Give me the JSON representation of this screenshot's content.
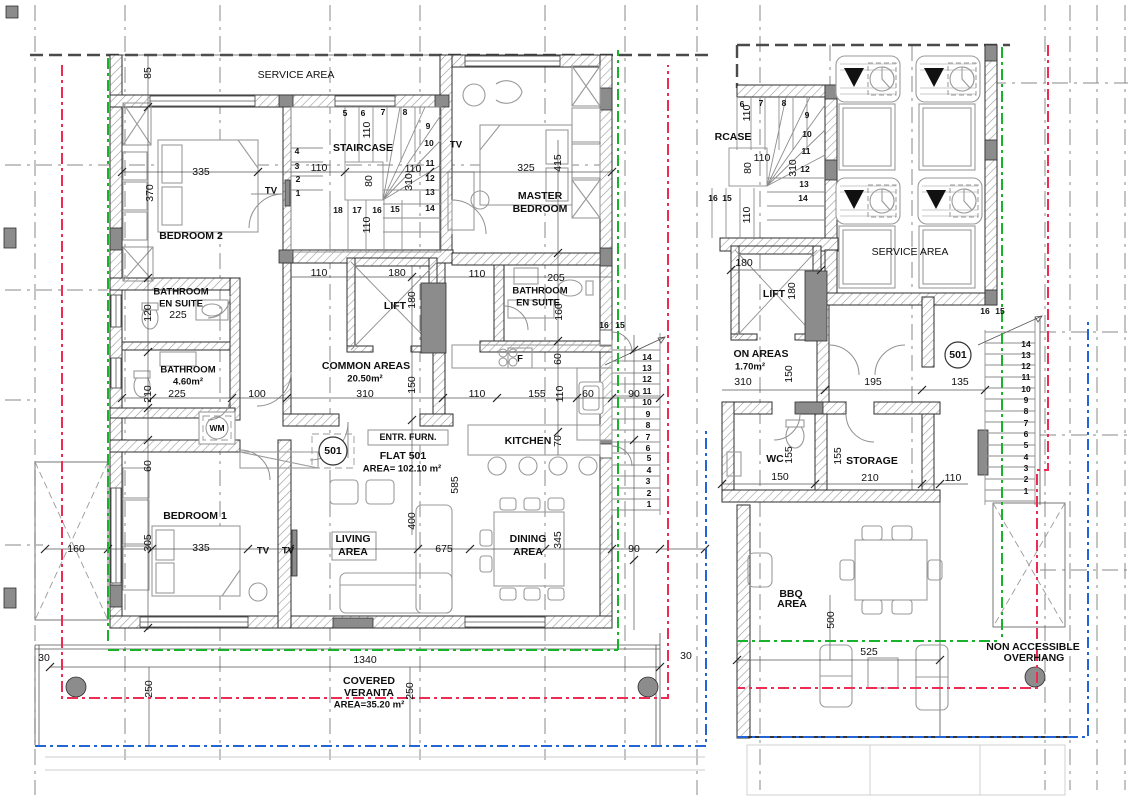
{
  "colors": {
    "green": "#18b32b",
    "red": "#ee2b52",
    "blue": "#2465d6",
    "wall": "#2e2e2e",
    "column": "#8c8c8c"
  },
  "left_plan": {
    "flat_number": "501",
    "texts": [
      {
        "x": 296,
        "y": 75,
        "t": "SERVICE AREA",
        "s": 10.5,
        "n": "room-label-service-area"
      },
      {
        "x": 148,
        "y": 73,
        "t": "85",
        "r": -90
      },
      {
        "x": 201,
        "y": 172,
        "t": "335"
      },
      {
        "x": 150,
        "y": 193,
        "t": "370",
        "r": -90
      },
      {
        "x": 191,
        "y": 236,
        "t": "BEDROOM 2",
        "b": 1,
        "n": "room-label-bedroom2"
      },
      {
        "x": 271,
        "y": 191,
        "t": "TV",
        "b": 1,
        "s": 9.5
      },
      {
        "x": 363,
        "y": 148,
        "t": "STAIRCASE",
        "b": 1,
        "n": "room-label-staircase"
      },
      {
        "x": 345,
        "y": 113,
        "t": "5",
        "b": 1,
        "s": 8.5
      },
      {
        "x": 363,
        "y": 113,
        "t": "6",
        "b": 1,
        "s": 8.5
      },
      {
        "x": 383,
        "y": 112,
        "t": "7",
        "b": 1,
        "s": 8.5
      },
      {
        "x": 405,
        "y": 112,
        "t": "8",
        "b": 1,
        "s": 8.5
      },
      {
        "x": 297,
        "y": 151,
        "t": "4",
        "b": 1,
        "s": 8.5
      },
      {
        "x": 297,
        "y": 166,
        "t": "3",
        "b": 1,
        "s": 8.5
      },
      {
        "x": 298,
        "y": 179,
        "t": "2",
        "b": 1,
        "s": 8.5
      },
      {
        "x": 298,
        "y": 193,
        "t": "1",
        "b": 1,
        "s": 8.5
      },
      {
        "x": 428,
        "y": 126,
        "t": "9",
        "b": 1,
        "s": 8.5
      },
      {
        "x": 429,
        "y": 143,
        "t": "10",
        "b": 1,
        "s": 8.5
      },
      {
        "x": 430,
        "y": 163,
        "t": "11",
        "b": 1,
        "s": 8.5
      },
      {
        "x": 430,
        "y": 178,
        "t": "12",
        "b": 1,
        "s": 8.5
      },
      {
        "x": 430,
        "y": 192,
        "t": "13",
        "b": 1,
        "s": 8.5
      },
      {
        "x": 430,
        "y": 208,
        "t": "14",
        "b": 1,
        "s": 8.5
      },
      {
        "x": 338,
        "y": 210,
        "t": "18",
        "b": 1,
        "s": 8.5
      },
      {
        "x": 357,
        "y": 210,
        "t": "17",
        "b": 1,
        "s": 8.5
      },
      {
        "x": 377,
        "y": 210,
        "t": "16",
        "b": 1,
        "s": 8.5
      },
      {
        "x": 395,
        "y": 209,
        "t": "15",
        "b": 1,
        "s": 8.5
      },
      {
        "x": 367,
        "y": 130,
        "t": "110",
        "r": -90
      },
      {
        "x": 319,
        "y": 168,
        "t": "110"
      },
      {
        "x": 413,
        "y": 169,
        "t": "110"
      },
      {
        "x": 409,
        "y": 182,
        "t": "310",
        "r": -90
      },
      {
        "x": 369,
        "y": 181,
        "t": "80",
        "r": -90
      },
      {
        "x": 367,
        "y": 225,
        "t": "110",
        "r": -90
      },
      {
        "x": 456,
        "y": 145,
        "t": "TV",
        "b": 1,
        "s": 9.5
      },
      {
        "x": 526,
        "y": 168,
        "t": "325"
      },
      {
        "x": 558,
        "y": 163,
        "t": "415",
        "r": -90
      },
      {
        "x": 540,
        "y": 196,
        "t": "MASTER",
        "b": 1,
        "n": "room-label-master-bedroom"
      },
      {
        "x": 540,
        "y": 209,
        "t": "BEDROOM",
        "b": 1
      },
      {
        "x": 181,
        "y": 292,
        "t": "BATHROOM",
        "b": 1,
        "s": 9.5,
        "n": "room-label-bathroom-ensuite-left"
      },
      {
        "x": 181,
        "y": 304,
        "t": "EN SUITE",
        "b": 1,
        "s": 9.5
      },
      {
        "x": 178,
        "y": 315,
        "t": "225"
      },
      {
        "x": 148,
        "y": 313,
        "t": "120",
        "r": -90
      },
      {
        "x": 188,
        "y": 370,
        "t": "BATHROOM",
        "b": 1,
        "s": 9.5,
        "n": "room-label-bathroom"
      },
      {
        "x": 188,
        "y": 382,
        "t": "4.60m²",
        "b": 1,
        "s": 9.5
      },
      {
        "x": 177,
        "y": 394,
        "t": "225"
      },
      {
        "x": 148,
        "y": 394,
        "t": "210",
        "r": -90
      },
      {
        "x": 540,
        "y": 291,
        "t": "BATHROOM",
        "b": 1,
        "s": 9.5,
        "n": "room-label-bathroom-ensuite-right"
      },
      {
        "x": 538,
        "y": 303,
        "t": "EN SUITE",
        "b": 1,
        "s": 9.5
      },
      {
        "x": 556,
        "y": 278,
        "t": "205"
      },
      {
        "x": 559,
        "y": 312,
        "t": "160",
        "r": -90
      },
      {
        "x": 395,
        "y": 306,
        "t": "LIFT",
        "b": 1,
        "n": "room-label-lift"
      },
      {
        "x": 412,
        "y": 300,
        "t": "180",
        "r": -90
      },
      {
        "x": 397,
        "y": 273,
        "t": "180"
      },
      {
        "x": 319,
        "y": 273,
        "t": "110"
      },
      {
        "x": 477,
        "y": 274,
        "t": "110"
      },
      {
        "x": 366,
        "y": 366,
        "t": "COMMON AREAS",
        "b": 1,
        "n": "room-label-common-areas"
      },
      {
        "x": 365,
        "y": 379,
        "t": "20.50m²",
        "b": 1,
        "s": 9.5
      },
      {
        "x": 365,
        "y": 394,
        "t": "310"
      },
      {
        "x": 412,
        "y": 385,
        "t": "150",
        "r": -90
      },
      {
        "x": 477,
        "y": 394,
        "t": "110"
      },
      {
        "x": 257,
        "y": 394,
        "t": "100"
      },
      {
        "x": 217,
        "y": 428,
        "t": "WM",
        "b": 1,
        "s": 8.5,
        "n": "washing-machine-label"
      },
      {
        "x": 408,
        "y": 437,
        "t": "ENTR. FURN.",
        "b": 1,
        "s": 9,
        "n": "entrance-furniture-label"
      },
      {
        "x": 403,
        "y": 456,
        "t": "FLAT 501",
        "b": 1,
        "n": "flat-title"
      },
      {
        "x": 402,
        "y": 469,
        "t": "AREA= 102.10 m²",
        "b": 1,
        "s": 9.5,
        "n": "flat-area"
      },
      {
        "x": 333,
        "y": 451,
        "t": "501",
        "b": 1,
        "n": "flat-badge"
      },
      {
        "x": 520,
        "y": 359,
        "t": "F",
        "b": 1,
        "s": 9.5,
        "n": "fridge-label"
      },
      {
        "x": 558,
        "y": 359,
        "t": "60",
        "r": -90
      },
      {
        "x": 537,
        "y": 394,
        "t": "155"
      },
      {
        "x": 560,
        "y": 394,
        "t": "110",
        "r": -90
      },
      {
        "x": 588,
        "y": 394,
        "t": "60"
      },
      {
        "x": 634,
        "y": 394,
        "t": "90"
      },
      {
        "x": 528,
        "y": 441,
        "t": "KITCHEN",
        "b": 1,
        "n": "room-label-kitchen"
      },
      {
        "x": 558,
        "y": 441,
        "t": "70",
        "r": -90
      },
      {
        "x": 604,
        "y": 325,
        "t": "16",
        "b": 1,
        "s": 8.5
      },
      {
        "x": 620,
        "y": 325,
        "t": "15",
        "b": 1,
        "s": 8.5
      },
      {
        "x": 647,
        "y": 357,
        "t": "14",
        "b": 1,
        "s": 8.5
      },
      {
        "x": 647,
        "y": 368,
        "t": "13",
        "b": 1,
        "s": 8.5
      },
      {
        "x": 647,
        "y": 379,
        "t": "12",
        "b": 1,
        "s": 8.5
      },
      {
        "x": 647,
        "y": 391,
        "t": "11",
        "b": 1,
        "s": 8.5
      },
      {
        "x": 647,
        "y": 402,
        "t": "10",
        "b": 1,
        "s": 8.5
      },
      {
        "x": 648,
        "y": 414,
        "t": "9",
        "b": 1,
        "s": 8.5
      },
      {
        "x": 648,
        "y": 425,
        "t": "8",
        "b": 1,
        "s": 8.5
      },
      {
        "x": 648,
        "y": 437,
        "t": "7",
        "b": 1,
        "s": 8.5
      },
      {
        "x": 648,
        "y": 448,
        "t": "6",
        "b": 1,
        "s": 8.5
      },
      {
        "x": 649,
        "y": 458,
        "t": "5",
        "b": 1,
        "s": 8.5
      },
      {
        "x": 649,
        "y": 470,
        "t": "4",
        "b": 1,
        "s": 8.5
      },
      {
        "x": 648,
        "y": 481,
        "t": "3",
        "b": 1,
        "s": 8.5
      },
      {
        "x": 649,
        "y": 493,
        "t": "2",
        "b": 1,
        "s": 8.5
      },
      {
        "x": 649,
        "y": 504,
        "t": "1",
        "b": 1,
        "s": 8.5
      },
      {
        "x": 195,
        "y": 516,
        "t": "BEDROOM 1",
        "b": 1,
        "n": "room-label-bedroom1"
      },
      {
        "x": 148,
        "y": 543,
        "t": "305",
        "r": -90
      },
      {
        "x": 201,
        "y": 548,
        "t": "335"
      },
      {
        "x": 76,
        "y": 549,
        "t": "160"
      },
      {
        "x": 148,
        "y": 466,
        "t": "60",
        "r": -90
      },
      {
        "x": 263,
        "y": 551,
        "t": "TV",
        "b": 1,
        "s": 9.5
      },
      {
        "x": 288,
        "y": 551,
        "t": "TV",
        "b": 1,
        "s": 9.5
      },
      {
        "x": 353,
        "y": 539,
        "t": "LIVING",
        "b": 1,
        "n": "room-label-living-area"
      },
      {
        "x": 353,
        "y": 552,
        "t": "AREA",
        "b": 1
      },
      {
        "x": 412,
        "y": 521,
        "t": "400",
        "r": -90
      },
      {
        "x": 444,
        "y": 549,
        "t": "675"
      },
      {
        "x": 455,
        "y": 485,
        "t": "585",
        "r": -90
      },
      {
        "x": 528,
        "y": 539,
        "t": "DINING",
        "b": 1,
        "n": "room-label-dining-area"
      },
      {
        "x": 528,
        "y": 552,
        "t": "AREA",
        "b": 1
      },
      {
        "x": 558,
        "y": 540,
        "t": "345",
        "r": -90
      },
      {
        "x": 634,
        "y": 549,
        "t": "90"
      },
      {
        "x": 44,
        "y": 658,
        "t": "30"
      },
      {
        "x": 686,
        "y": 656,
        "t": "30"
      },
      {
        "x": 365,
        "y": 660,
        "t": "1340"
      },
      {
        "x": 369,
        "y": 681,
        "t": "COVERED",
        "b": 1,
        "n": "room-label-veranda"
      },
      {
        "x": 369,
        "y": 693,
        "t": "VERANTA",
        "b": 1
      },
      {
        "x": 369,
        "y": 705,
        "t": "AREA=35.20 m²",
        "b": 1,
        "s": 9.5
      },
      {
        "x": 149,
        "y": 689,
        "t": "250",
        "r": -90
      },
      {
        "x": 410,
        "y": 691,
        "t": "250",
        "r": -90
      }
    ]
  },
  "right_plan": {
    "flat_number": "501",
    "texts": [
      {
        "x": 910,
        "y": 252,
        "t": "SERVICE AREA",
        "s": 10.5,
        "n": "room-label-service-area"
      },
      {
        "x": 733,
        "y": 137,
        "t": "RCASE",
        "b": 1,
        "n": "room-label-staircase-partial"
      },
      {
        "x": 742,
        "y": 104,
        "t": "6",
        "b": 1,
        "s": 8.5
      },
      {
        "x": 761,
        "y": 103,
        "t": "7",
        "b": 1,
        "s": 8.5
      },
      {
        "x": 784,
        "y": 103,
        "t": "8",
        "b": 1,
        "s": 8.5
      },
      {
        "x": 807,
        "y": 115,
        "t": "9",
        "b": 1,
        "s": 8.5
      },
      {
        "x": 807,
        "y": 134,
        "t": "10",
        "b": 1,
        "s": 8.5
      },
      {
        "x": 806,
        "y": 151,
        "t": "11",
        "b": 1,
        "s": 8.5
      },
      {
        "x": 805,
        "y": 169,
        "t": "12",
        "b": 1,
        "s": 8.5
      },
      {
        "x": 804,
        "y": 184,
        "t": "13",
        "b": 1,
        "s": 8.5
      },
      {
        "x": 803,
        "y": 198,
        "t": "14",
        "b": 1,
        "s": 8.5
      },
      {
        "x": 713,
        "y": 198,
        "t": "16",
        "b": 1,
        "s": 8.5
      },
      {
        "x": 727,
        "y": 198,
        "t": "15",
        "b": 1,
        "s": 8.5
      },
      {
        "x": 747,
        "y": 113,
        "t": "110",
        "r": -90
      },
      {
        "x": 762,
        "y": 158,
        "t": "110"
      },
      {
        "x": 793,
        "y": 168,
        "t": "310",
        "r": -90
      },
      {
        "x": 748,
        "y": 168,
        "t": "80",
        "r": -90
      },
      {
        "x": 747,
        "y": 215,
        "t": "110",
        "r": -90
      },
      {
        "x": 744,
        "y": 263,
        "t": "180"
      },
      {
        "x": 774,
        "y": 294,
        "t": "LIFT",
        "b": 1,
        "n": "room-label-lift"
      },
      {
        "x": 792,
        "y": 291,
        "t": "180",
        "r": -90
      },
      {
        "x": 761,
        "y": 354,
        "t": "ON AREAS",
        "b": 1,
        "n": "room-label-common-areas-partial"
      },
      {
        "x": 750,
        "y": 367,
        "t": "1.70m²",
        "b": 1,
        "s": 9.5
      },
      {
        "x": 743,
        "y": 382,
        "t": "310"
      },
      {
        "x": 789,
        "y": 374,
        "t": "150",
        "r": -90
      },
      {
        "x": 873,
        "y": 382,
        "t": "195"
      },
      {
        "x": 960,
        "y": 382,
        "t": "135"
      },
      {
        "x": 958,
        "y": 355,
        "t": "501",
        "b": 1,
        "n": "flat-badge"
      },
      {
        "x": 985,
        "y": 311,
        "t": "16",
        "b": 1,
        "s": 8.5
      },
      {
        "x": 1000,
        "y": 311,
        "t": "15",
        "b": 1,
        "s": 8.5
      },
      {
        "x": 1026,
        "y": 344,
        "t": "14",
        "b": 1,
        "s": 8.5
      },
      {
        "x": 1026,
        "y": 355,
        "t": "13",
        "b": 1,
        "s": 8.5
      },
      {
        "x": 1026,
        "y": 366,
        "t": "12",
        "b": 1,
        "s": 8.5
      },
      {
        "x": 1026,
        "y": 377,
        "t": "11",
        "b": 1,
        "s": 8.5
      },
      {
        "x": 1026,
        "y": 389,
        "t": "10",
        "b": 1,
        "s": 8.5
      },
      {
        "x": 1026,
        "y": 400,
        "t": "9",
        "b": 1,
        "s": 8.5
      },
      {
        "x": 1026,
        "y": 411,
        "t": "8",
        "b": 1,
        "s": 8.5
      },
      {
        "x": 1026,
        "y": 423,
        "t": "7",
        "b": 1,
        "s": 8.5
      },
      {
        "x": 1026,
        "y": 434,
        "t": "6",
        "b": 1,
        "s": 8.5
      },
      {
        "x": 1026,
        "y": 445,
        "t": "5",
        "b": 1,
        "s": 8.5
      },
      {
        "x": 1026,
        "y": 457,
        "t": "4",
        "b": 1,
        "s": 8.5
      },
      {
        "x": 1026,
        "y": 468,
        "t": "3",
        "b": 1,
        "s": 8.5
      },
      {
        "x": 1026,
        "y": 479,
        "t": "2",
        "b": 1,
        "s": 8.5
      },
      {
        "x": 1026,
        "y": 491,
        "t": "1",
        "b": 1,
        "s": 8.5
      },
      {
        "x": 775,
        "y": 459,
        "t": "WC",
        "b": 1,
        "n": "room-label-wc"
      },
      {
        "x": 780,
        "y": 477,
        "t": "150"
      },
      {
        "x": 789,
        "y": 455,
        "t": "155",
        "r": -90
      },
      {
        "x": 872,
        "y": 461,
        "t": "STORAGE",
        "b": 1,
        "n": "room-label-storage"
      },
      {
        "x": 870,
        "y": 478,
        "t": "210"
      },
      {
        "x": 838,
        "y": 456,
        "t": "155",
        "r": -90
      },
      {
        "x": 953,
        "y": 478,
        "t": "110"
      },
      {
        "x": 791,
        "y": 594,
        "t": "BBQ",
        "b": 1,
        "n": "room-label-bbq-area"
      },
      {
        "x": 792,
        "y": 604,
        "t": "AREA",
        "b": 1
      },
      {
        "x": 831,
        "y": 620,
        "t": "500",
        "r": -90
      },
      {
        "x": 869,
        "y": 652,
        "t": "525"
      },
      {
        "x": 1033,
        "y": 647,
        "t": "NON ACCESSIBLE",
        "b": 1,
        "n": "overhang-label"
      },
      {
        "x": 1034,
        "y": 658,
        "t": "OVERHANG",
        "b": 1
      }
    ]
  }
}
